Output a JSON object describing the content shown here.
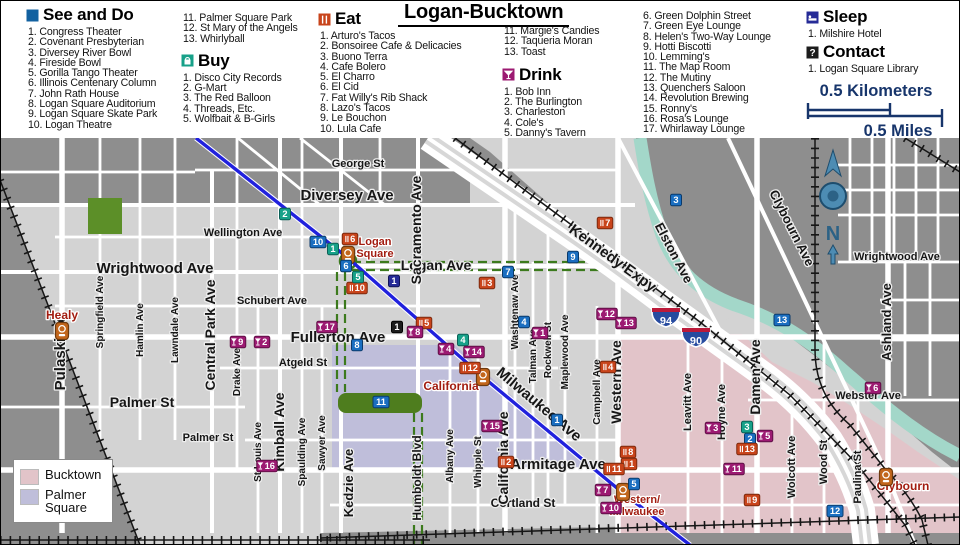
{
  "title": "Logan-Bucktown",
  "legend": {
    "see_and_do": {
      "title": "See and Do",
      "items": [
        "Congress Theater",
        "Covenant Presbyterian",
        "Diversey River Bowl",
        "Fireside Bowl",
        "Gorilla Tango Theater",
        "Illinois Centenary Column",
        "John Rath House",
        "Logan Square Auditorium",
        "Logan Square Skate Park",
        "Logan Theatre",
        "Palmer Square Park",
        "St Mary of the Angels",
        "Whirlyball"
      ]
    },
    "buy": {
      "title": "Buy",
      "items": [
        "Disco City Records",
        "G-Mart",
        "The Red Balloon",
        "Threads, Etc.",
        "Wolfbait & B-Girls"
      ]
    },
    "eat": {
      "title": "Eat",
      "items": [
        "Arturo's Tacos",
        "Bonsoiree Cafe & Delicacies",
        "Buono Terra",
        "Cafe Bolero",
        "El Charro",
        "El Cid",
        "Fat Willy's Rib Shack",
        "Lazo's Tacos",
        "Le Bouchon",
        "Lula Cafe",
        "Margie's Candies",
        "Taqueria Moran",
        "Toast"
      ]
    },
    "drink": {
      "title": "Drink",
      "items": [
        "Bob Inn",
        "The Burlington",
        "Charleston",
        "Cole's",
        "Danny's Tavern",
        "Green Dolphin Street",
        "Green Eye Lounge",
        "Helen's Two-Way Lounge",
        "Hotti Biscotti",
        "Lemming's",
        "The Map Room",
        "The Mutiny",
        "Quenchers Saloon",
        "Revolution Brewing",
        "Ronny's",
        "Rosa's Lounge",
        "Whirlaway Lounge"
      ]
    },
    "sleep": {
      "title": "Sleep",
      "items": [
        "Milshire Hotel"
      ]
    },
    "contact": {
      "title": "Contact",
      "items": [
        "Logan Square Library"
      ]
    }
  },
  "scale": {
    "kilometers": "0.5 Kilometers",
    "miles": "0.5 Miles"
  },
  "map_legend": {
    "bucktown": "Bucktown",
    "palmer_square": "Palmer Square"
  },
  "compass": {
    "label": "N"
  },
  "colors": {
    "see": {
      "f": "#1a6ec0",
      "s": "#0a3a6b"
    },
    "eat": {
      "f": "#c8441b",
      "s": "#7c2a0e"
    },
    "buy": {
      "f": "#17a189",
      "s": "#0b6157"
    },
    "drink": {
      "f": "#9c1a72",
      "s": "#5e0f45"
    },
    "sleep": {
      "f": "#262b97",
      "s": "#121457"
    },
    "contact": {
      "f": "#1c1c1c",
      "s": "#000000"
    },
    "station": "#c2661c",
    "bucktown": "#e2c4c9",
    "palmer_square": "#bfbeda",
    "blue_line": "#2121dd",
    "park_green": "#4e7d1e",
    "river": "#a3d7c9",
    "scale_text": "#17356b"
  },
  "map": {
    "shields": [
      {
        "n": "94",
        "x": 666,
        "y": 318
      },
      {
        "n": "90",
        "x": 696,
        "y": 338
      }
    ],
    "stations": [
      {
        "n": "Healy",
        "x": 62,
        "y": 331
      },
      {
        "n": "Logan Square",
        "x": 348,
        "y": 255
      },
      {
        "n": "California",
        "x": 483,
        "y": 377
      },
      {
        "n": "Western/Milwaukee",
        "x": 623,
        "y": 492
      },
      {
        "n": "Clybourn",
        "x": 886,
        "y": 477
      }
    ],
    "labels": [
      {
        "t": "George St",
        "x": 358,
        "y": 167,
        "s": 11
      },
      {
        "t": "Diversey Ave",
        "x": 347,
        "y": 200,
        "s": 15
      },
      {
        "t": "Wellington Ave",
        "x": 243,
        "y": 236,
        "s": 11
      },
      {
        "t": "Wrightwood Ave",
        "x": 155,
        "y": 273,
        "s": 15
      },
      {
        "t": "Wrightwood Ave",
        "x": 897,
        "y": 260,
        "s": 11
      },
      {
        "t": "Schubert Ave",
        "x": 272,
        "y": 304,
        "s": 11
      },
      {
        "t": "Fullerton Ave",
        "x": 338,
        "y": 342,
        "s": 15
      },
      {
        "t": "Atgeld St",
        "x": 303,
        "y": 366,
        "s": 11
      },
      {
        "t": "Palmer St",
        "x": 142,
        "y": 407,
        "s": 14
      },
      {
        "t": "Palmer St",
        "x": 208,
        "y": 441,
        "s": 11
      },
      {
        "t": "Logan Ave",
        "x": 436,
        "y": 270,
        "s": 14
      },
      {
        "t": "Armitage Ave",
        "x": 558,
        "y": 469,
        "s": 15
      },
      {
        "t": "Cortland St",
        "x": 523,
        "y": 507,
        "s": 12
      },
      {
        "t": "Webster Ave",
        "x": 868,
        "y": 399,
        "s": 11
      },
      {
        "t": "Kennedy Expy",
        "x": 610,
        "y": 262,
        "r": 36,
        "s": 15
      },
      {
        "t": "Elston Ave",
        "x": 670,
        "y": 255,
        "r": 62,
        "s": 13
      },
      {
        "t": "Clybourn Ave",
        "x": 788,
        "y": 230,
        "r": 63,
        "s": 13
      },
      {
        "t": "Milwaukee Ave",
        "x": 536,
        "y": 408,
        "r": 40,
        "s": 15
      },
      {
        "t": "Pulaski Rd",
        "x": 65,
        "y": 352,
        "r": -90,
        "s": 15
      },
      {
        "t": "Springfield Ave",
        "x": 103,
        "y": 312,
        "r": -90,
        "s": 10
      },
      {
        "t": "Hamlin Ave",
        "x": 143,
        "y": 330,
        "r": -90,
        "s": 10
      },
      {
        "t": "Lawndale Ave",
        "x": 178,
        "y": 330,
        "r": -90,
        "s": 10
      },
      {
        "t": "Central Park Ave",
        "x": 215,
        "y": 335,
        "r": -90,
        "s": 14
      },
      {
        "t": "Drake Ave",
        "x": 240,
        "y": 372,
        "r": -90,
        "s": 10
      },
      {
        "t": "St Louis Ave",
        "x": 261,
        "y": 452,
        "r": -90,
        "s": 10
      },
      {
        "t": "Kimball Ave",
        "x": 284,
        "y": 432,
        "r": -90,
        "s": 14
      },
      {
        "t": "Spaulding Ave",
        "x": 305,
        "y": 452,
        "r": -90,
        "s": 10
      },
      {
        "t": "Sawyer Ave",
        "x": 325,
        "y": 443,
        "r": -90,
        "s": 10
      },
      {
        "t": "Kedzie Ave",
        "x": 353,
        "y": 483,
        "r": -90,
        "s": 13
      },
      {
        "t": "Humboldt Blvd",
        "x": 421,
        "y": 478,
        "r": -90,
        "s": 12
      },
      {
        "t": "Sacramento Ave",
        "x": 421,
        "y": 230,
        "r": -90,
        "s": 14
      },
      {
        "t": "Albany Ave",
        "x": 453,
        "y": 456,
        "r": -90,
        "s": 10
      },
      {
        "t": "Whipple St",
        "x": 481,
        "y": 462,
        "r": -90,
        "s": 10
      },
      {
        "t": "California Ave",
        "x": 508,
        "y": 458,
        "r": -90,
        "s": 14
      },
      {
        "t": "Washtenaw Ave",
        "x": 518,
        "y": 312,
        "r": -90,
        "s": 10
      },
      {
        "t": "Talman Ave",
        "x": 536,
        "y": 356,
        "r": -90,
        "s": 10
      },
      {
        "t": "Rockwell St",
        "x": 551,
        "y": 350,
        "r": -90,
        "s": 10
      },
      {
        "t": "Maplewood Ave",
        "x": 568,
        "y": 352,
        "r": -90,
        "s": 10
      },
      {
        "t": "Campbell Ave",
        "x": 600,
        "y": 392,
        "r": -90,
        "s": 10
      },
      {
        "t": "Western Ave",
        "x": 621,
        "y": 382,
        "r": -90,
        "s": 14
      },
      {
        "t": "Leavitt Ave",
        "x": 691,
        "y": 402,
        "r": -90,
        "s": 11
      },
      {
        "t": "Hoyne Ave",
        "x": 725,
        "y": 412,
        "r": -90,
        "s": 11
      },
      {
        "t": "Damen Ave",
        "x": 760,
        "y": 377,
        "r": -90,
        "s": 14
      },
      {
        "t": "Wolcott Ave",
        "x": 795,
        "y": 467,
        "r": -90,
        "s": 11
      },
      {
        "t": "Wood St",
        "x": 827,
        "y": 462,
        "r": -90,
        "s": 11
      },
      {
        "t": "Paulina St",
        "x": 861,
        "y": 477,
        "r": -90,
        "s": 11
      },
      {
        "t": "Ashland Ave",
        "x": 891,
        "y": 322,
        "r": -90,
        "s": 13
      },
      {
        "t": "Healy",
        "x": 62,
        "y": 319,
        "s": 12,
        "c": "st"
      },
      {
        "t": "Logan",
        "x": 375,
        "y": 245,
        "s": 11,
        "c": "st",
        "a": "s"
      },
      {
        "t": "Square",
        "x": 375,
        "y": 257,
        "s": 11,
        "c": "st",
        "a": "s"
      },
      {
        "t": "California",
        "x": 451,
        "y": 390,
        "s": 12,
        "c": "st"
      },
      {
        "t": "Western/",
        "x": 637,
        "y": 503,
        "s": 11,
        "c": "st",
        "a": "s"
      },
      {
        "t": "Milwaukee",
        "x": 637,
        "y": 515,
        "s": 11,
        "c": "st",
        "a": "s"
      },
      {
        "t": "Clybourn",
        "x": 903,
        "y": 490,
        "s": 12,
        "c": "st"
      },
      {
        "t": "N",
        "x": 833,
        "y": 240,
        "s": 20,
        "c": "cmp"
      }
    ],
    "markers": [
      {
        "cat": "see",
        "n": 1,
        "x": 557,
        "y": 420
      },
      {
        "cat": "see",
        "n": 2,
        "x": 750,
        "y": 439
      },
      {
        "cat": "see",
        "n": 3,
        "x": 676,
        "y": 200
      },
      {
        "cat": "see",
        "n": 4,
        "x": 524,
        "y": 322
      },
      {
        "cat": "see",
        "n": 5,
        "x": 634,
        "y": 484
      },
      {
        "cat": "see",
        "n": 6,
        "x": 346,
        "y": 266
      },
      {
        "cat": "see",
        "n": 7,
        "x": 508,
        "y": 272
      },
      {
        "cat": "see",
        "n": 8,
        "x": 357,
        "y": 345
      },
      {
        "cat": "see",
        "n": 9,
        "x": 573,
        "y": 257
      },
      {
        "cat": "see",
        "n": 10,
        "x": 318,
        "y": 242
      },
      {
        "cat": "see",
        "n": 11,
        "x": 381,
        "y": 402
      },
      {
        "cat": "see",
        "n": 12,
        "x": 835,
        "y": 511
      },
      {
        "cat": "see",
        "n": 13,
        "x": 782,
        "y": 320
      },
      {
        "cat": "eat",
        "n": 1,
        "x": 629,
        "y": 464
      },
      {
        "cat": "eat",
        "n": 2,
        "x": 506,
        "y": 462
      },
      {
        "cat": "eat",
        "n": 3,
        "x": 487,
        "y": 283
      },
      {
        "cat": "eat",
        "n": 4,
        "x": 608,
        "y": 367
      },
      {
        "cat": "eat",
        "n": 5,
        "x": 424,
        "y": 323
      },
      {
        "cat": "eat",
        "n": 6,
        "x": 350,
        "y": 239
      },
      {
        "cat": "eat",
        "n": 7,
        "x": 605,
        "y": 223
      },
      {
        "cat": "eat",
        "n": 8,
        "x": 628,
        "y": 452
      },
      {
        "cat": "eat",
        "n": 9,
        "x": 752,
        "y": 500
      },
      {
        "cat": "eat",
        "n": 10,
        "x": 357,
        "y": 288
      },
      {
        "cat": "eat",
        "n": 11,
        "x": 614,
        "y": 469
      },
      {
        "cat": "eat",
        "n": 12,
        "x": 470,
        "y": 368
      },
      {
        "cat": "eat",
        "n": 13,
        "x": 747,
        "y": 449
      },
      {
        "cat": "buy",
        "n": 1,
        "x": 333,
        "y": 249
      },
      {
        "cat": "buy",
        "n": 2,
        "x": 285,
        "y": 214
      },
      {
        "cat": "buy",
        "n": 3,
        "x": 747,
        "y": 427
      },
      {
        "cat": "buy",
        "n": 4,
        "x": 463,
        "y": 340
      },
      {
        "cat": "buy",
        "n": 5,
        "x": 358,
        "y": 277
      },
      {
        "cat": "drink",
        "n": 1,
        "x": 540,
        "y": 333
      },
      {
        "cat": "drink",
        "n": 2,
        "x": 262,
        "y": 342
      },
      {
        "cat": "drink",
        "n": 3,
        "x": 713,
        "y": 428
      },
      {
        "cat": "drink",
        "n": 4,
        "x": 446,
        "y": 349
      },
      {
        "cat": "drink",
        "n": 5,
        "x": 765,
        "y": 436
      },
      {
        "cat": "drink",
        "n": 6,
        "x": 873,
        "y": 388
      },
      {
        "cat": "drink",
        "n": 7,
        "x": 603,
        "y": 490
      },
      {
        "cat": "drink",
        "n": 8,
        "x": 415,
        "y": 332
      },
      {
        "cat": "drink",
        "n": 9,
        "x": 238,
        "y": 342
      },
      {
        "cat": "drink",
        "n": 10,
        "x": 611,
        "y": 508
      },
      {
        "cat": "drink",
        "n": 11,
        "x": 734,
        "y": 469
      },
      {
        "cat": "drink",
        "n": 12,
        "x": 607,
        "y": 314
      },
      {
        "cat": "drink",
        "n": 13,
        "x": 626,
        "y": 323
      },
      {
        "cat": "drink",
        "n": 14,
        "x": 474,
        "y": 352
      },
      {
        "cat": "drink",
        "n": 15,
        "x": 492,
        "y": 426
      },
      {
        "cat": "drink",
        "n": 16,
        "x": 267,
        "y": 466
      },
      {
        "cat": "drink",
        "n": 17,
        "x": 327,
        "y": 327
      },
      {
        "cat": "sleep",
        "n": 1,
        "x": 394,
        "y": 281
      },
      {
        "cat": "contact",
        "n": 1,
        "x": 397,
        "y": 327
      }
    ]
  }
}
